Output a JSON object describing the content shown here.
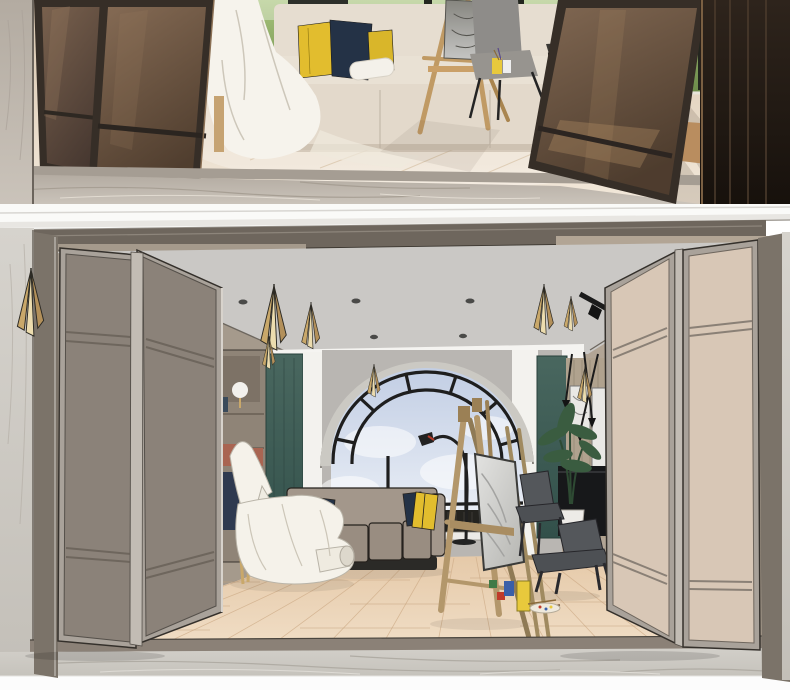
{
  "meta": {
    "kind": "interior product composite image",
    "width_px": 790,
    "height_px": 690,
    "visible_text": "none"
  },
  "sections": {
    "top_photo": {
      "name": "photo-showroom",
      "description": "photograph of an art-studio lounge seen through open bronze-framed folding glass partition doors",
      "objects": [
        "left-marble-wall",
        "left-folding-glass-doors",
        "white-drop-cloth",
        "paper-roll",
        "bench-sofa",
        "yellow-pillows",
        "navy-pillows",
        "garden-window",
        "dark-curtain",
        "artist-easel",
        "sketch-canvas",
        "gray-upholstered-chair",
        "black-side-chair",
        "white-side-table",
        "paint-cups",
        "light-wood-floor",
        "marble-step-floor",
        "right-folding-glass-door",
        "stacked-dark-door-panels"
      ]
    },
    "bottom_render": {
      "name": "render-showroom",
      "description": "3D sketch rendering of the matching room with folding partition doors open",
      "objects": [
        "crown-molding",
        "partition-track-header",
        "left-marble-wall",
        "gold-wall-sconce",
        "left-folding-door-panels",
        "gray-ceiling",
        "recessed-spotlights",
        "gold-cone-pendants",
        "black-track-light",
        "white-window-soffit",
        "bookshelf",
        "sphere-table-lamp",
        "teal-wall-panels",
        "white-pilasters",
        "arched-window",
        "sky-view",
        "window-radiator",
        "modular-sofa",
        "white-drop-cloth-sculpture",
        "arc-floor-lamp",
        "artist-easels",
        "marble-canvas",
        "dark-chairs",
        "potted-plant",
        "tv-console",
        "wall-art-frames",
        "paint-supplies",
        "wood-plank-floor",
        "threshold-track",
        "marble-foreground-floor",
        "right-folding-door-panels",
        "door-jambs"
      ]
    }
  },
  "palette": {
    "ph-floor-1": "#d9c6ae",
    "ph-floor-2": "#f2e8da",
    "ph-marble-1": "#cac3ba",
    "ph-marble-2": "#b3aba1",
    "ph-door-frame": "#362e27",
    "ph-glass-l1": "#7d6450",
    "ph-glass-l2": "#463730",
    "ph-glass-r1": "#8d7159",
    "ph-glass-r2": "#523f2f",
    "ph-window-green-1": "#a9c47d",
    "ph-window-green-2": "#6c8c4a",
    "ph-curtain": "#2d2f2a",
    "ph-sofa": "#e9e1d4",
    "ph-chair-gray": "#8e8c89",
    "ph-easel-wood": "#c09a64",
    "ph-stack-1": "#2e241c",
    "ph-stack-2": "#17110c",
    "pillow-yellow": "#e2bd2e",
    "pillow-navy": "#243246",
    "molding": "#fafaf8",
    "header-taupe": "#6e665d",
    "ceiling": "#cac8c5",
    "marble-wall-1": "#d6d3cd",
    "marble-wall-2": "#c3bfb8",
    "jamb": "#7b7369",
    "door-left-panel": "#8b8279",
    "door-right-panel": "#d8c7b6",
    "door-metal": "#a9a29a",
    "teal-1": "#49675f",
    "teal-2": "#32504a",
    "pilaster": "#f3f2ee",
    "wall-gray": "#b9b6b2",
    "window-stone": "#cbc9c3",
    "mullion": "#1e1e1e",
    "sky-1": "#c2cee4",
    "sky-2": "#eef2f8",
    "sofa-taupe": "#a3978b",
    "sofa-base": "#2b2a27",
    "floor-wood-1": "#e5c9a8",
    "floor-wood-2": "#f0ddc5",
    "threshold": "#8b8177",
    "marble-floor-1": "#d2cfc9",
    "marble-floor-2": "#c3c0b9",
    "bottom-white": "#fcfcfc",
    "gold": "#c9a86a",
    "gold-cream": "#ecdcae",
    "plant-green": "#3a5c40",
    "console-black": "#17181a",
    "canvas-1": "#e3e3e1",
    "canvas-2": "#b5b5b1",
    "drape": "#f5f2ea",
    "chair-dark": "#54575b",
    "paint-yellow": "#e8c93c",
    "paint-blue": "#3a5fa8",
    "paint-red": "#c03a2a",
    "paint-green": "#3f7a46",
    "book-navy": "#2f3a50",
    "box-salmon": "#a96552",
    "wood-wall": "#b0a28e",
    "easel-wood": "#b3976b",
    "track-black": "#1b1b1b"
  }
}
